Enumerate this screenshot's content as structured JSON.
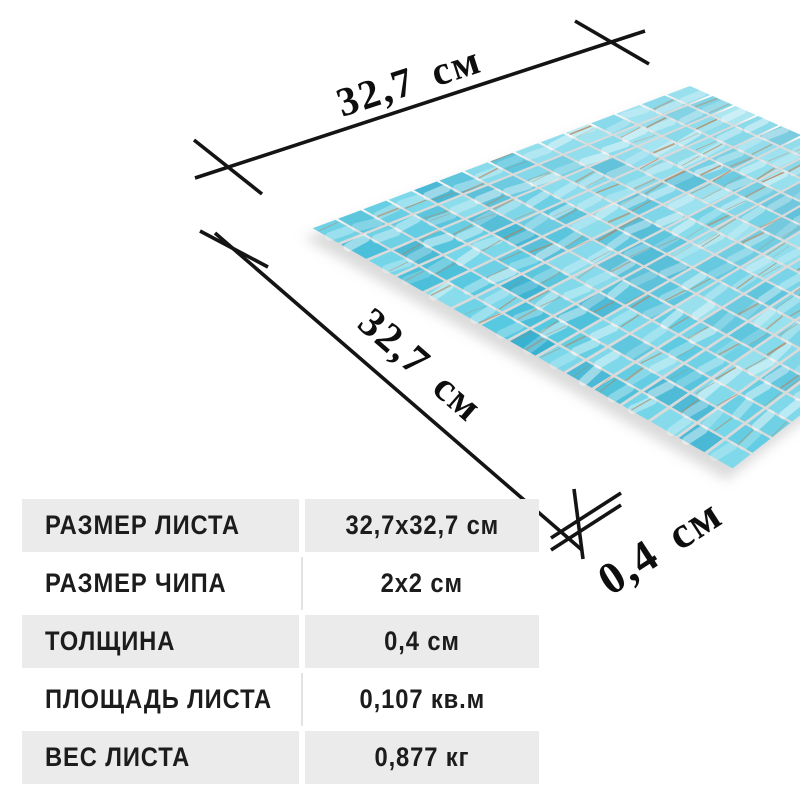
{
  "dimension_labels": {
    "width": "32,7 см",
    "height": "32,7 см",
    "thickness": "0,4 см"
  },
  "spec_table": {
    "row_alt_color": "#ebebeb",
    "text_color": "#1c1c1c",
    "rows": [
      {
        "label": "РАЗМЕР ЛИСТА",
        "value": "32,7x32,7 см"
      },
      {
        "label": "РАЗМЕР ЧИПА",
        "value": "2x2 см"
      },
      {
        "label": "ТОЛЩИНА",
        "value": "0,4 см"
      },
      {
        "label": "ПЛОЩАДЬ ЛИСТА",
        "value": "0,107 кв.м"
      },
      {
        "label": "ВЕС ЛИСТА",
        "value": "0,877 кг"
      }
    ]
  },
  "mosaic": {
    "grid": 15,
    "chip_inset": 0.05,
    "corners": {
      "west": [
        310,
        228
      ],
      "north": [
        690,
        85
      ],
      "east": [
        1031,
        235
      ],
      "south": [
        733,
        470
      ]
    },
    "palette": [
      "#55c8e0",
      "#6ed3e7",
      "#43bcd8",
      "#7fd9ea",
      "#4cc0da",
      "#63cde3",
      "#39b2d1",
      "#74d5e8"
    ],
    "streak_color": "#b5835a",
    "shadow_color": "#bcbcbc"
  }
}
